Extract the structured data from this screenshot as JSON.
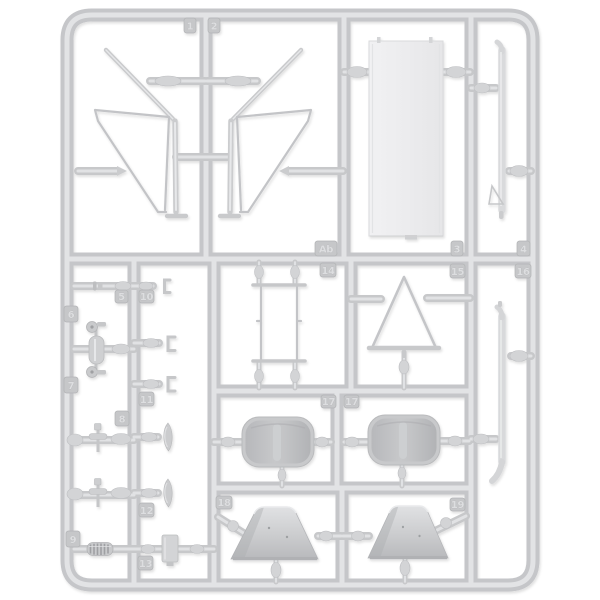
{
  "sprue": {
    "code": "Ab",
    "colors": {
      "background": "#ffffff",
      "plastic": "#c9cacc",
      "plastic_highlight": "#e2e3e5",
      "plastic_shade": "#aeafb2",
      "clear_panel": "#eeeef0",
      "tag_face": "#c6c7c9",
      "tag_text": "#dddee0"
    },
    "tags": {
      "t1": "1",
      "t2": "2",
      "t3": "3",
      "t4": "4",
      "t5": "5",
      "t6": "6",
      "t7": "7",
      "t8": "8",
      "t9": "9",
      "t10": "10",
      "t11": "11",
      "t12": "12",
      "t13": "13",
      "t14": "14",
      "t15": "15",
      "t16": "16",
      "t17a": "17",
      "t17b": "17",
      "t18": "18",
      "t19": "19",
      "tAb": "Ab"
    }
  }
}
